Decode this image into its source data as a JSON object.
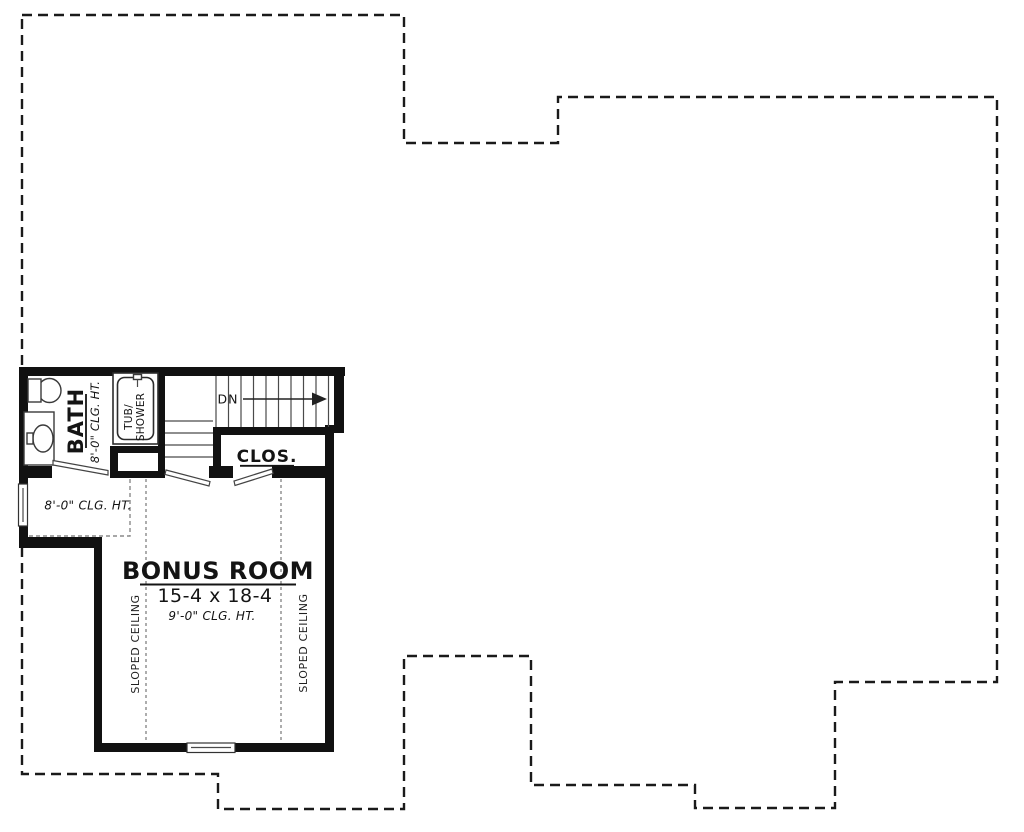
{
  "plan": {
    "colors": {
      "background": "#ffffff",
      "wall_ink": "#111111",
      "thin_line": "#4a4a4a",
      "annotation_dash": "#8a8a8a"
    },
    "rooms": {
      "bath": {
        "label": "BATH",
        "ceiling": "8'-0\" CLG. HT."
      },
      "closet": {
        "label": "CLOS."
      },
      "bonus": {
        "label": "BONUS ROOM",
        "dimensions": "15-4 x 18-4",
        "ceiling": "9'-0\" CLG. HT."
      }
    },
    "stairs": {
      "down_label": "DN"
    },
    "fixtures": {
      "tub_shower_line1": "TUB/",
      "tub_shower_line2": "SHOWER"
    },
    "annotations": {
      "left_ceiling": "8'-0\" CLG. HT.",
      "sloped_left": "SLOPED CEILING",
      "sloped_right": "SLOPED CEILING"
    }
  }
}
